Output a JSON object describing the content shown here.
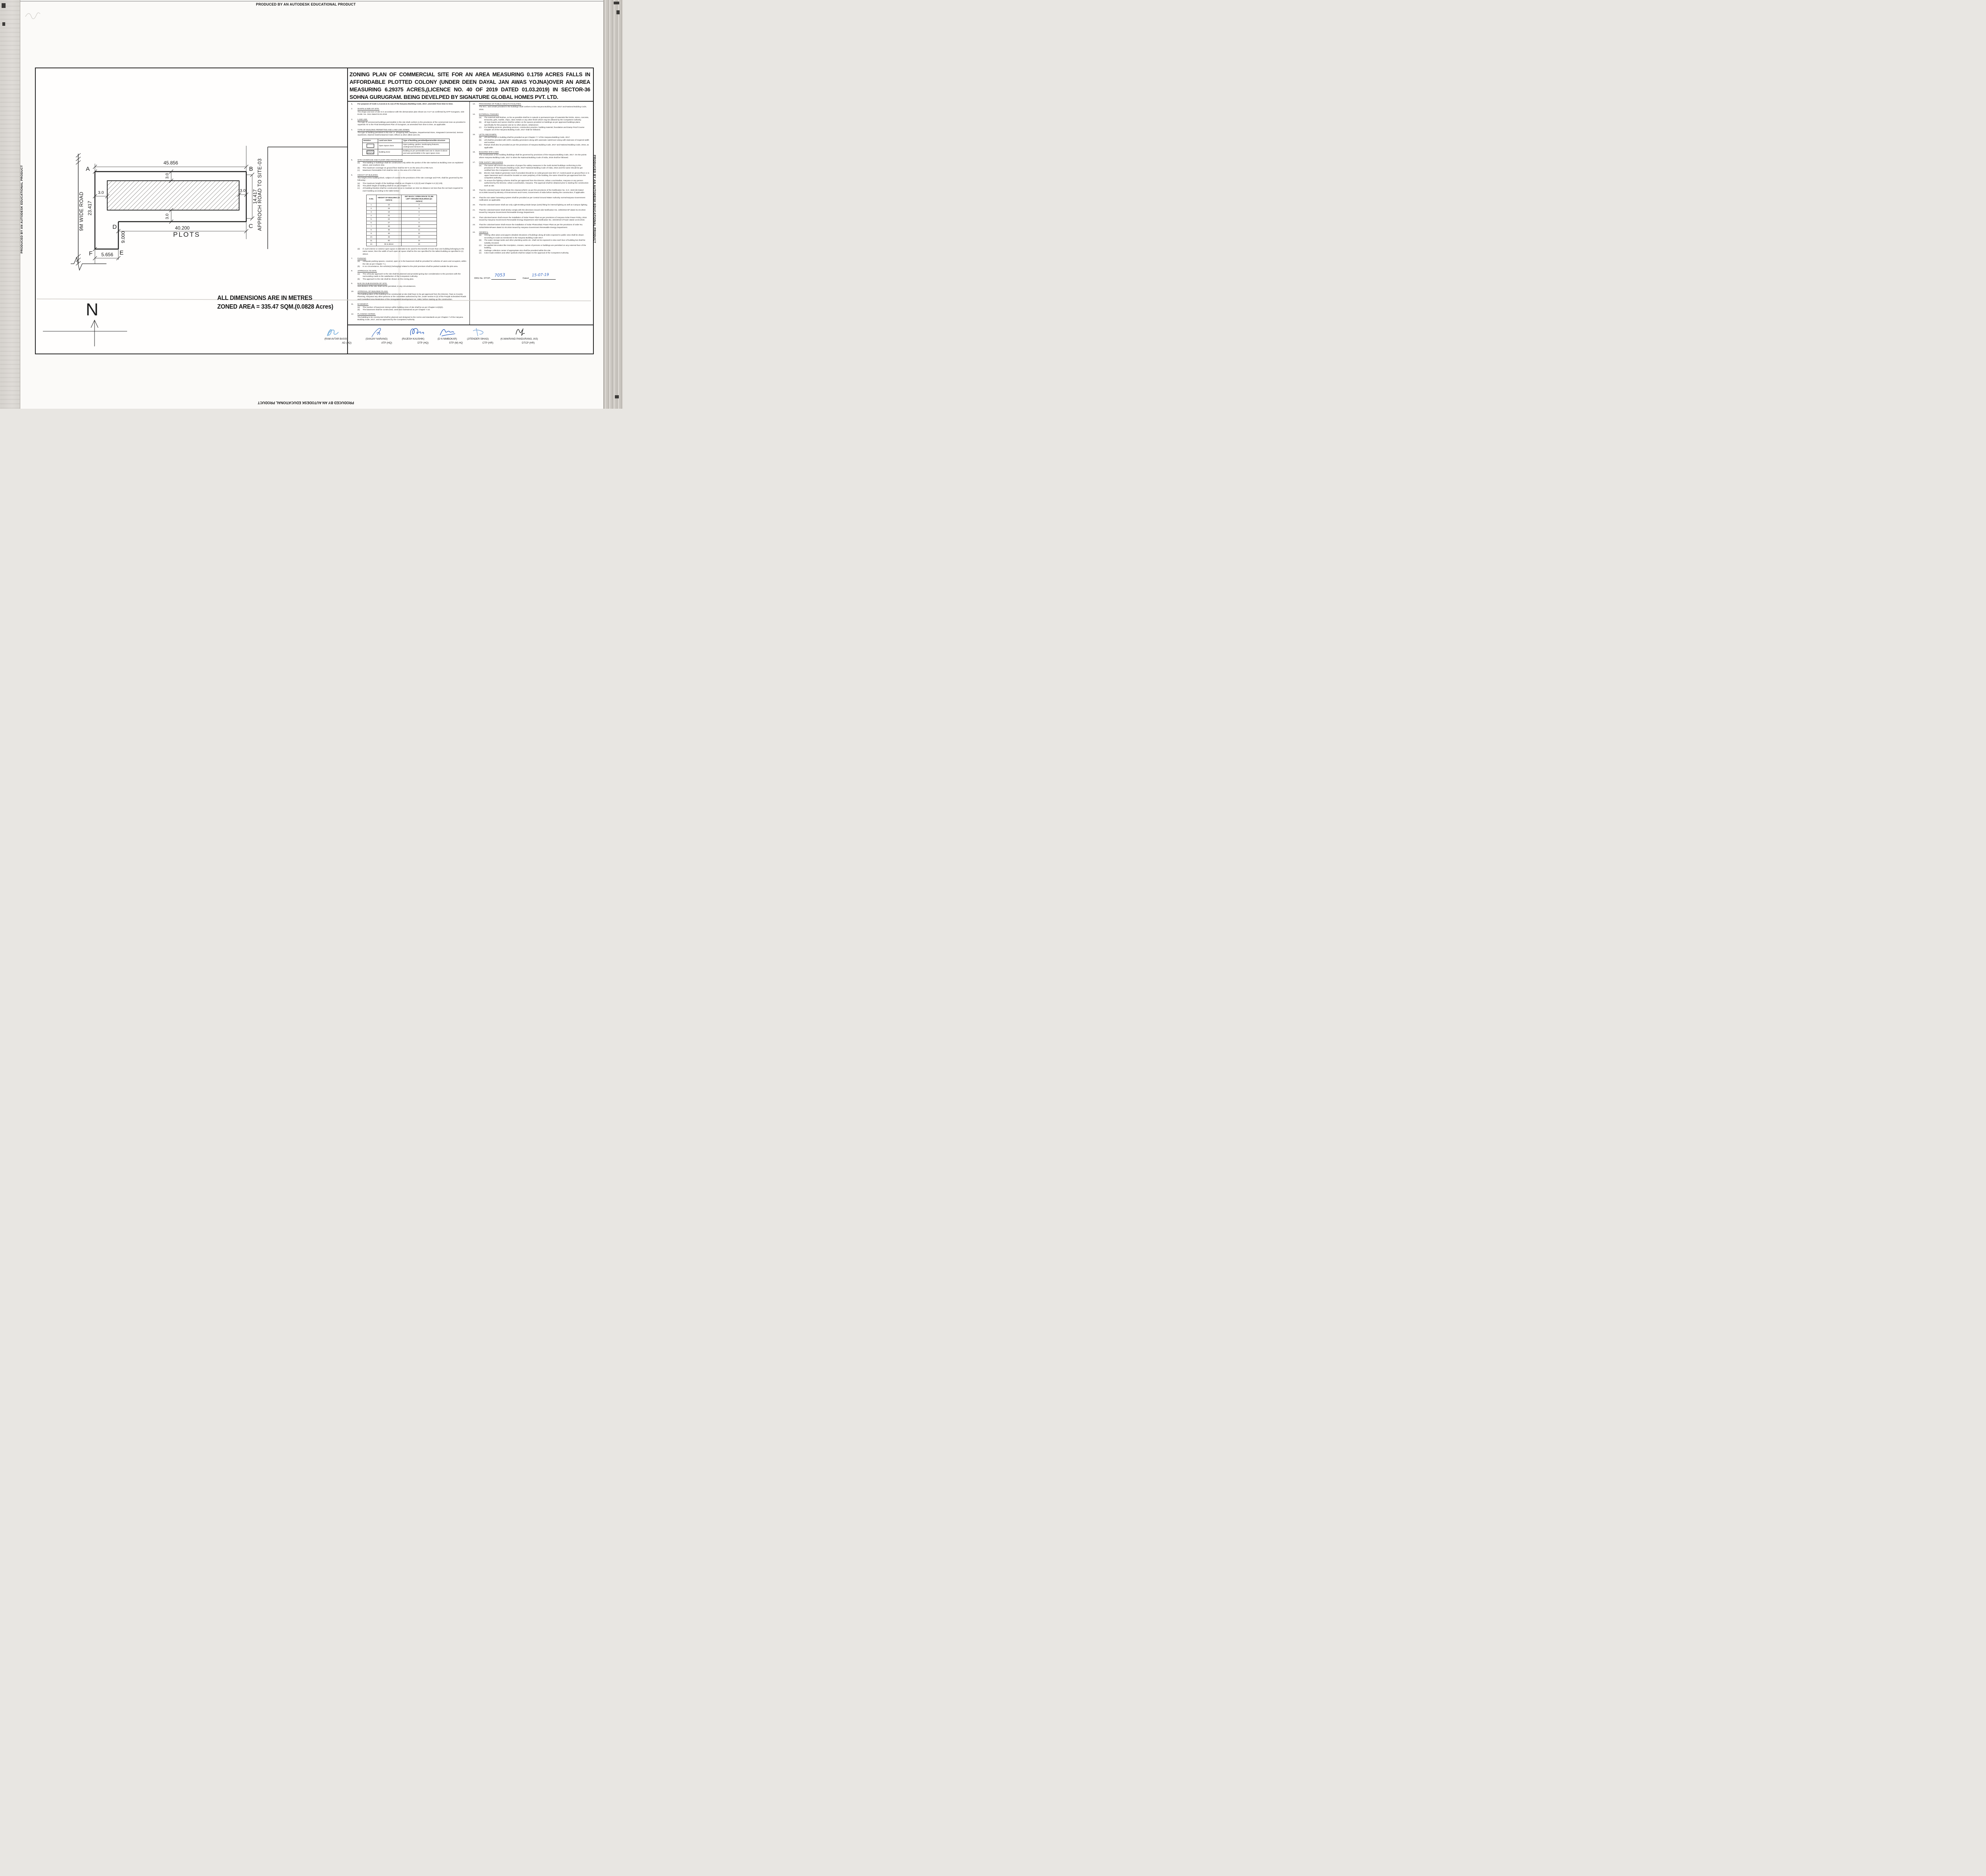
{
  "edge_text": "PRODUCED BY AN AUTODESK EDUCATIONAL PRODUCT",
  "title_lines": [
    "ZONING PLAN OF COMMERCIAL SITE FOR AN AREA MEASURING 0.1759 ACRES FALLS IN",
    "AFFORDABLE PLOTTED COLONY (UNDER DEEN DAYAL JAN AWAS YOJNA)OVER AN AREA",
    "MEASURING 6.29375 ACRES,(LICENCE NO. 40 OF 2019 DATED 01.03.2019) IN SECTOR-36",
    "SOHNA GURUGRAM. BEING DEVELPED BY SIGNATURE GLOBAL HOMES PVT. LTD."
  ],
  "site_plan": {
    "dim_top": "45.856",
    "dim_left": "23.417",
    "dim_right": "14.417",
    "dim_bottom": "40.200",
    "dim_fe": "5.656",
    "dim_de": "9.000",
    "setback_top": "3.0",
    "setback_left": "3.0",
    "setback_right": "3.0",
    "setback_bottom": "3.0",
    "corner_a": "A",
    "corner_b": "B",
    "corner_c": "C",
    "corner_d": "D",
    "corner_e": "E",
    "corner_f": "F",
    "road_left": "9M WIDE ROAD",
    "road_right": "APPROCH ROAD TO SITE-03",
    "plots": "PLOTS",
    "north": "N",
    "note_line1": "ALL DIMENSIONS ARE IN METRES",
    "note_line2": "ZONED AREA = 335.47 SQM.(0.0828 Acres)"
  },
  "notation_table": {
    "headers": [
      "Notation",
      "Land use Zone",
      "Type of Building permitted/permissible structure"
    ],
    "rows": [
      {
        "swatch": "open",
        "zone": "Open Space Zone",
        "type": "Open parking, garden,  landscaping features, underground services etc."
      },
      {
        "swatch": "hatched",
        "zone": "Building Zone",
        "type": "Building as per permissible land use in clause-iii above and uses permissible in the open space zone."
      }
    ]
  },
  "height_table": {
    "headers": [
      "S.No.",
      "HEIGHT OF BUILDING (in meters)",
      "SET BACK / OPEN SPACE TO BE LEFT AROUND BUILDINGS.(in meters)"
    ],
    "rows": [
      [
        "1.",
        "10",
        "3"
      ],
      [
        "2.",
        "15",
        "5"
      ],
      [
        "3.",
        "18",
        "6"
      ],
      [
        "4.",
        "21",
        "7"
      ],
      [
        "5.",
        "24",
        "8"
      ],
      [
        "6.",
        "27",
        "9"
      ],
      [
        "7.",
        "30",
        "10"
      ],
      [
        "8.",
        "35",
        "11"
      ],
      [
        "9.",
        "40",
        "12"
      ],
      [
        "10.",
        "45",
        "13"
      ],
      [
        "11.",
        "50",
        "14"
      ],
      [
        "12.",
        "55 & above",
        "16"
      ]
    ]
  },
  "notes_left": [
    {
      "num": "1.",
      "bold": true,
      "body": "For purpose of Code 1.2 (xcvi) & 6.1 (1) of the Haryana Building Code, 2017, amended from time to time."
    },
    {
      "num": "2.",
      "heading": "SHAPE & SIZE OF SITE.",
      "body": "The shape and size of site is in accordance with the demarcation plan shown as A to F as confirmed by DTP Gurugram, vide Endst. No. 3112 dated 03.04.2019"
    },
    {
      "num": "3.",
      "heading": "LAND USE.",
      "body": "The type of commercial buildings permissible in this site shall conform to the provisions of the commercial zone as provided in Appendix 'B' to the Final Development Plan of Gurugram, as amended from time to time, as applicable."
    },
    {
      "num": "4.",
      "heading": "TYPE OF BUILDING PERMITTED AND LAND USE ZONES.",
      "body": "The type of building permitted in this site i.e. Shopping Mall, Multiplex, Departmental Store, Integrated Commercial, Service Apartment, Starred Hotel/Unstarred Hotel, Offices & other allied uses etc.",
      "table": "notation"
    },
    {
      "num": "5.",
      "heading": "SITE COVERAGE AND FLOOR AREA RATIO (FAR)",
      "subs": [
        {
          "k": "(a)",
          "t": "The building or buildings shall be constructed only within the portion of the site marked as Building zone as explained above, and nowhere else."
        },
        {
          "k": "(b)",
          "t": "The maximum coverage on ground floor shall be 60 % on the area of 0.1759 Acre."
        },
        {
          "k": "(c)",
          "t": "Maximum Permissible FAR shall be 150  on the area of 0.1759 Acre."
        }
      ]
    },
    {
      "num": "6.",
      "heading": "HEIGHT OF BUILDING.",
      "body": "The height of the building block, subject  of course to the provisions of the site coverage and FAR, shall be governed by the following:-",
      "subs": [
        {
          "k": "(a)",
          "t": "The maximum height of the buildings shall be as Chapter 6.3 (3) (ii) and Chapter 6.3 (3) (Viii)."
        },
        {
          "k": "(b)",
          "t": "The plinth height of building shall be as per Chapter 7.3."
        },
        {
          "k": "(c)",
          "t": "All building block(s) shall be constructed so as to maintain an inter-se distance not less than the set back required for each building according to the table below:-"
        }
      ],
      "table": "height",
      "subs2": [
        {
          "k": "(d)",
          "t": "If, such interior or exterior open space is intended to be used for the benefit of more than one building belonging to the same owner, then the width of such open air space shall be the one specified for the tallest building as specified in (c) above."
        }
      ]
    },
    {
      "num": "7.",
      "heading": "PARKING",
      "subs": [
        {
          "k": "(a)",
          "t": "Adequate parking spaces, covered, open or in the basement shall be provided for vehicles of users and occupiers, within the site as per Chapter 7.1."
        },
        {
          "k": "(b)",
          "t": "In no circumstance, the vehicle(s) belonging/ related to the plot/ premises shall be parked outside the plot area."
        }
      ]
    },
    {
      "num": "8.",
      "heading": "APPROACH TO SITE.",
      "subs": [
        {
          "k": "(a)",
          "t": "The vehicular approach to the site shall be planned and provided giving due consideration to the junctions with the surrounding roads to the satisfaction of the Competent Authority."
        },
        {
          "k": "(b)",
          "t": "The approach to the site shall be shown on the zoning plan."
        }
      ]
    },
    {
      "num": "9.",
      "heading": "BAR ON SUB-DIVISION OF SITE.",
      "body": "Sub-division of the site shall not be permitted, in any circumstances."
    },
    {
      "num": "10.",
      "heading": "APPROVAL OF BUILDING PLANS.",
      "body": "The building plans of the building to be constructed at site shall have to be got approved from the Director, Town & Country Planning, Haryana/ any other persons or the committee authorized by him, under section 8 (2) of the Punjab Scheduled Roads and Controlled Area Restriction of the Unregulated Development Act, 1963, before starting up the construction."
    },
    {
      "num": "11.",
      "heading": "BASEMENT.",
      "subs": [
        {
          "k": "(a)",
          "t": "The number of basement storeys within building zone of site shall be as per Chapter 6.3(3)(ii)."
        },
        {
          "k": "(b)",
          "t": "The basement shall be constructed, used and maintained as per Chapter 7.16."
        }
      ]
    },
    {
      "num": "12.",
      "heading": "PLANNING NORMS.",
      "body": "The building to be constructed shall be planned and designed to the norms and standards as per Chapter-7 of the Haryana Building Code, 2017, and as approved by the Competent Authority."
    }
  ],
  "notes_right": [
    {
      "num": "13.",
      "heading": "PROVISIONS OF PUBLIC HEALTH FACILITIES.",
      "body": "The W.C. and urinals provided in the buildings shall conform to the Haryana Building Code, 2017 and National Building Code, 2016."
    },
    {
      "num": "14.",
      "heading": "EXTERNAL FINISHES",
      "subs": [
        {
          "k": "(a)",
          "t": "The external wall finishes, so far as possible shall be in natural or permanent type of materials like bricks, stone, concrete, terracotta, grits, marble, chips, class metals or any other finish which may be allowed by the Competent Authority."
        },
        {
          "k": "(b)",
          "t": "All sign boards and names shall be written on the spaces provided on buildings as per approved buildings plans specifically for this purpose and at no other places, whatsoever."
        },
        {
          "k": "(c)",
          "t": "For building services, plumbing services, construction practice, building material, foundation and Damp Proof Course Chapter 10 of the Haryana Building Code, 2017 shall be followed."
        }
      ]
    },
    {
      "num": "15.",
      "heading": "LIFTS AND RAMPS.",
      "subs": [
        {
          "k": "(a)",
          "t": "Lift and Ramps in building shall be provided as per Chapter 7.7 of the Haryana Building Code, 2017."
        },
        {
          "k": "(b)",
          "t": "Lift shall be provided with 100% standby generators along with automatic switchover along with staircase of required width and number."
        },
        {
          "k": "(c)",
          "t": "Ramps shall also be provided as per the provisions of Haryana Building Code, 2017 and National Building Code, 2016, as applicable."
        }
      ]
    },
    {
      "num": "16.",
      "heading": "BUILDING BYE-LAWS",
      "body": "The construction of the building /buildings shall be governed by provisions of the Haryana Building Code, 2017. On the points where Haryana Building Code, 2017 is silent the National Building Code of India, 2016 shall be followed."
    },
    {
      "num": "17.",
      "heading": "FIRE SAFETY MEASURES",
      "subs": [
        {
          "k": "(a)",
          "t": "The owner will ensure the provision of proper fire safety measures in the multi storied buildings conforming to the provisions of The Haryana Building Code, 2017/ National Building Code of India, 2016 and the same should be got certified form the Competent Authority."
        },
        {
          "k": "(b)",
          "t": "Electric Sub Station/ generator room if provided should be on solid ground near DG/ LT. Control panel on ground floor or in upper basement and it should be located on outer periphery of the building, the same should be got approved form the competent authority."
        },
        {
          "k": "(c)",
          "t": "To ensure fire fighting scheme shall be got approved from the Director, Urban Local Bodies, Haryana or any person authorized by the Director, Urban Local Bodies, Haryana. This approval shall be obtained prior to starting the construction work at site."
        }
      ]
    },
    {
      "num": "18.",
      "body": "That the coloniser/owner shall obtain the clearance/NOC as per the provisions of the Notification No. S.O. 1533 (E) Dated 14.9.2006  issued by Ministry of Environment and Forest, Government of India  before starting the construction, if applicable."
    },
    {
      "num": "19.",
      "body": "That the rain water harvesting system shall be provided as per Central Ground Water Authority norms/Haryana Government notification as applicable."
    },
    {
      "num": "20.",
      "body": "That the coloniser/owner shall use only Light-Emitting Diode lamps (LED) fitting for internal lighting as well as Campus lighting."
    },
    {
      "num": "21.",
      "body": "That the coloniser/owner shall strictly comply with the directions issued vide Notification No. 19/6/2016-5P dated 31.03.2016 issued by Haryana Government Renewable Energy Department."
    },
    {
      "num": "22.",
      "body": "That coloniser/owner shall ensure the installation of Solar Power Plant as per provisions of Haryana Solar Power Policy, 2016 issued by Haryana Government Renewable Energy Department vide Notification No. 19/4/2016-5 Power dated 14.03.2016."
    },
    {
      "num": "23.",
      "body": "That the coloniser/owner shall ensure the installation of Solar Photovoltaic Power Plant as per the provisions of order No. 22/52/2005-5Power dated 21.03.2016 issued by Haryana Government Renewable Energy Department."
    },
    {
      "num": "24.",
      "heading": "GENERAL",
      "subs": [
        {
          "k": "(a)",
          "t": "Among other plans and papers detailed elevations of buildings along all sides exposed to public view shall be drawn according to scale as mentioned in the Haryana Building Code-2017."
        },
        {
          "k": "(b)",
          "t": "The water storage tanks and other plumbing works etc. shall not be exposed to view each face of building but shall be suitably encased."
        },
        {
          "k": "(c)",
          "t": "No applied decoration like inscription, crosses, names of persons or buildings are permitted on any external face of the building."
        },
        {
          "k": "(d)",
          "t": "Garbage collection center of appropriate size shall be provided within the site."
        },
        {
          "k": "(e)",
          "t": "Color trade emblem and other symbols shall be subject to the approval of the Competent Authority."
        }
      ]
    }
  ],
  "drg": {
    "label": "DRG No. DTCP-",
    "number": "7053",
    "dated_label": "Dated",
    "date": "15-07-19"
  },
  "signatures": [
    {
      "name": "(RAM AVTAR BASSI)",
      "designation": "AD (HQ)"
    },
    {
      "name": "(SANJAY NARANG)",
      "designation": "ATP (HQ)"
    },
    {
      "name": "(RAJESH KAUSHIK)",
      "designation": "DTP (HQ)"
    },
    {
      "name": "(D N NIMBOKAR)",
      "designation": "STP (M) HQ"
    },
    {
      "name": "(JITENDER SIHAG)",
      "designation": "CTP (HR)"
    },
    {
      "name": "(K.MAKRAND PANDURANG, IAS)",
      "designation": "DTCP (HR)"
    }
  ]
}
